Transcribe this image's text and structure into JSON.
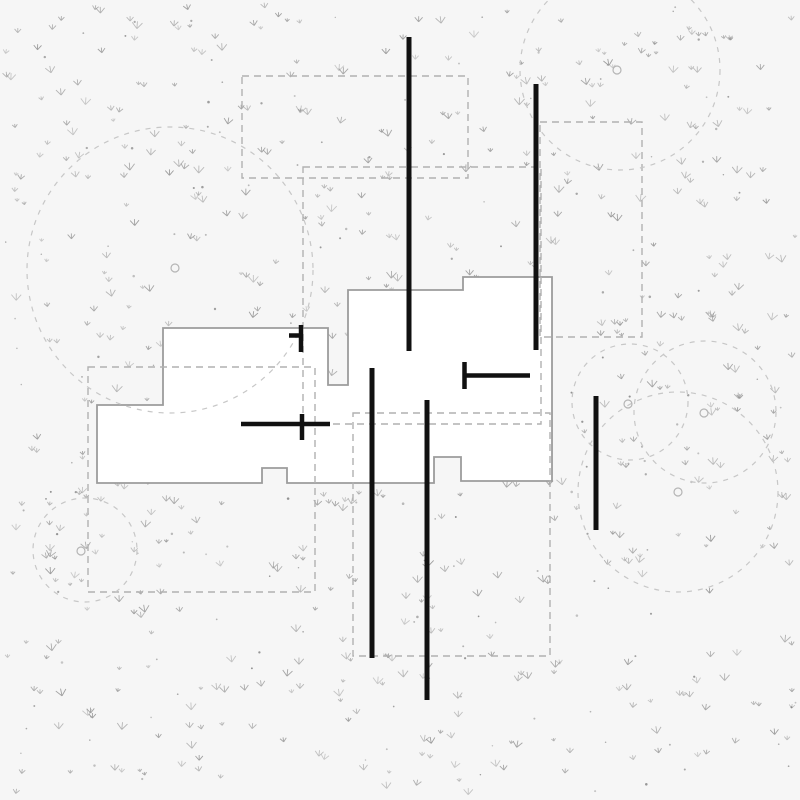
{
  "meta": {
    "description": "architectural-site-plan",
    "canvas": {
      "width": 800,
      "height": 800
    }
  },
  "palette": {
    "ground": "#f6f6f6",
    "building_fill": "#ffffff",
    "building_stroke": "#9c9c9c",
    "boundary_dash": "#b1b1b1",
    "canopy_dash": "#c7c7c7",
    "trunk_stroke": "#b5b5b5",
    "wall_black": "#111111",
    "grass": "#949494",
    "dot": "#6f6f6f"
  },
  "building": {
    "polygon": [
      [
        163,
        328
      ],
      [
        328,
        328
      ],
      [
        328,
        385
      ],
      [
        348,
        385
      ],
      [
        348,
        290
      ],
      [
        463,
        290
      ],
      [
        463,
        277
      ],
      [
        552,
        277
      ],
      [
        552,
        481
      ],
      [
        461,
        481
      ],
      [
        461,
        457
      ],
      [
        434,
        457
      ],
      [
        434,
        483
      ],
      [
        287,
        483
      ],
      [
        287,
        468
      ],
      [
        262,
        468
      ],
      [
        262,
        483
      ],
      [
        97,
        483
      ],
      [
        97,
        405
      ],
      [
        163,
        405
      ]
    ],
    "stroke_width": 1.8
  },
  "boundaries": [
    {
      "x": 88,
      "y": 367,
      "w": 227,
      "h": 225
    },
    {
      "x": 242,
      "y": 76,
      "w": 226,
      "h": 102
    },
    {
      "x": 303,
      "y": 167,
      "w": 238,
      "h": 257
    },
    {
      "x": 353,
      "y": 413,
      "w": 197,
      "h": 243
    },
    {
      "x": 540,
      "y": 122,
      "w": 102,
      "h": 215
    }
  ],
  "tree_canopies": [
    {
      "cx": 170,
      "cy": 270,
      "r": 143
    },
    {
      "cx": 620,
      "cy": 70,
      "r": 100
    },
    {
      "cx": 630,
      "cy": 402,
      "r": 58
    },
    {
      "cx": 705,
      "cy": 412,
      "r": 71
    },
    {
      "cx": 678,
      "cy": 492,
      "r": 100
    },
    {
      "cx": 85,
      "cy": 550,
      "r": 52
    }
  ],
  "tree_trunks": [
    {
      "cx": 175,
      "cy": 268
    },
    {
      "cx": 617,
      "cy": 70
    },
    {
      "cx": 628,
      "cy": 404
    },
    {
      "cx": 704,
      "cy": 413
    },
    {
      "cx": 678,
      "cy": 492
    },
    {
      "cx": 81,
      "cy": 551
    }
  ],
  "trunk_radius": 4,
  "walls": [
    {
      "x1": 409,
      "y1": 37,
      "x2": 409,
      "y2": 351,
      "w": 5
    },
    {
      "x1": 536,
      "y1": 84,
      "x2": 536,
      "y2": 350,
      "w": 5
    },
    {
      "x1": 372,
      "y1": 368,
      "x2": 372,
      "y2": 658,
      "w": 5
    },
    {
      "x1": 427,
      "y1": 400,
      "x2": 427,
      "y2": 700,
      "w": 5
    },
    {
      "x1": 596,
      "y1": 396,
      "x2": 596,
      "y2": 530,
      "w": 5
    }
  ],
  "door_markers": [
    {
      "x1": 463,
      "y1": 375.5,
      "x2": 530,
      "y2": 375.5,
      "w": 4.5
    },
    {
      "x1": 464.5,
      "y1": 362,
      "x2": 464.5,
      "y2": 389,
      "w": 4.5
    },
    {
      "x1": 241,
      "y1": 424,
      "x2": 330,
      "y2": 424,
      "w": 4.5
    },
    {
      "x1": 302,
      "y1": 414,
      "x2": 302,
      "y2": 440,
      "w": 4.5
    },
    {
      "x1": 301,
      "y1": 325,
      "x2": 301,
      "y2": 352,
      "w": 4.5
    },
    {
      "x1": 289,
      "y1": 335.5,
      "x2": 303,
      "y2": 335.5,
      "w": 4.5
    }
  ],
  "grass": {
    "seed": 1337,
    "tuft_count": 470,
    "dot_count": 150
  },
  "style": {
    "boundary_dasharray": "7 5",
    "boundary_stroke_width": 1.4,
    "canopy_dasharray": "5 6",
    "canopy_stroke_width": 1.2
  }
}
